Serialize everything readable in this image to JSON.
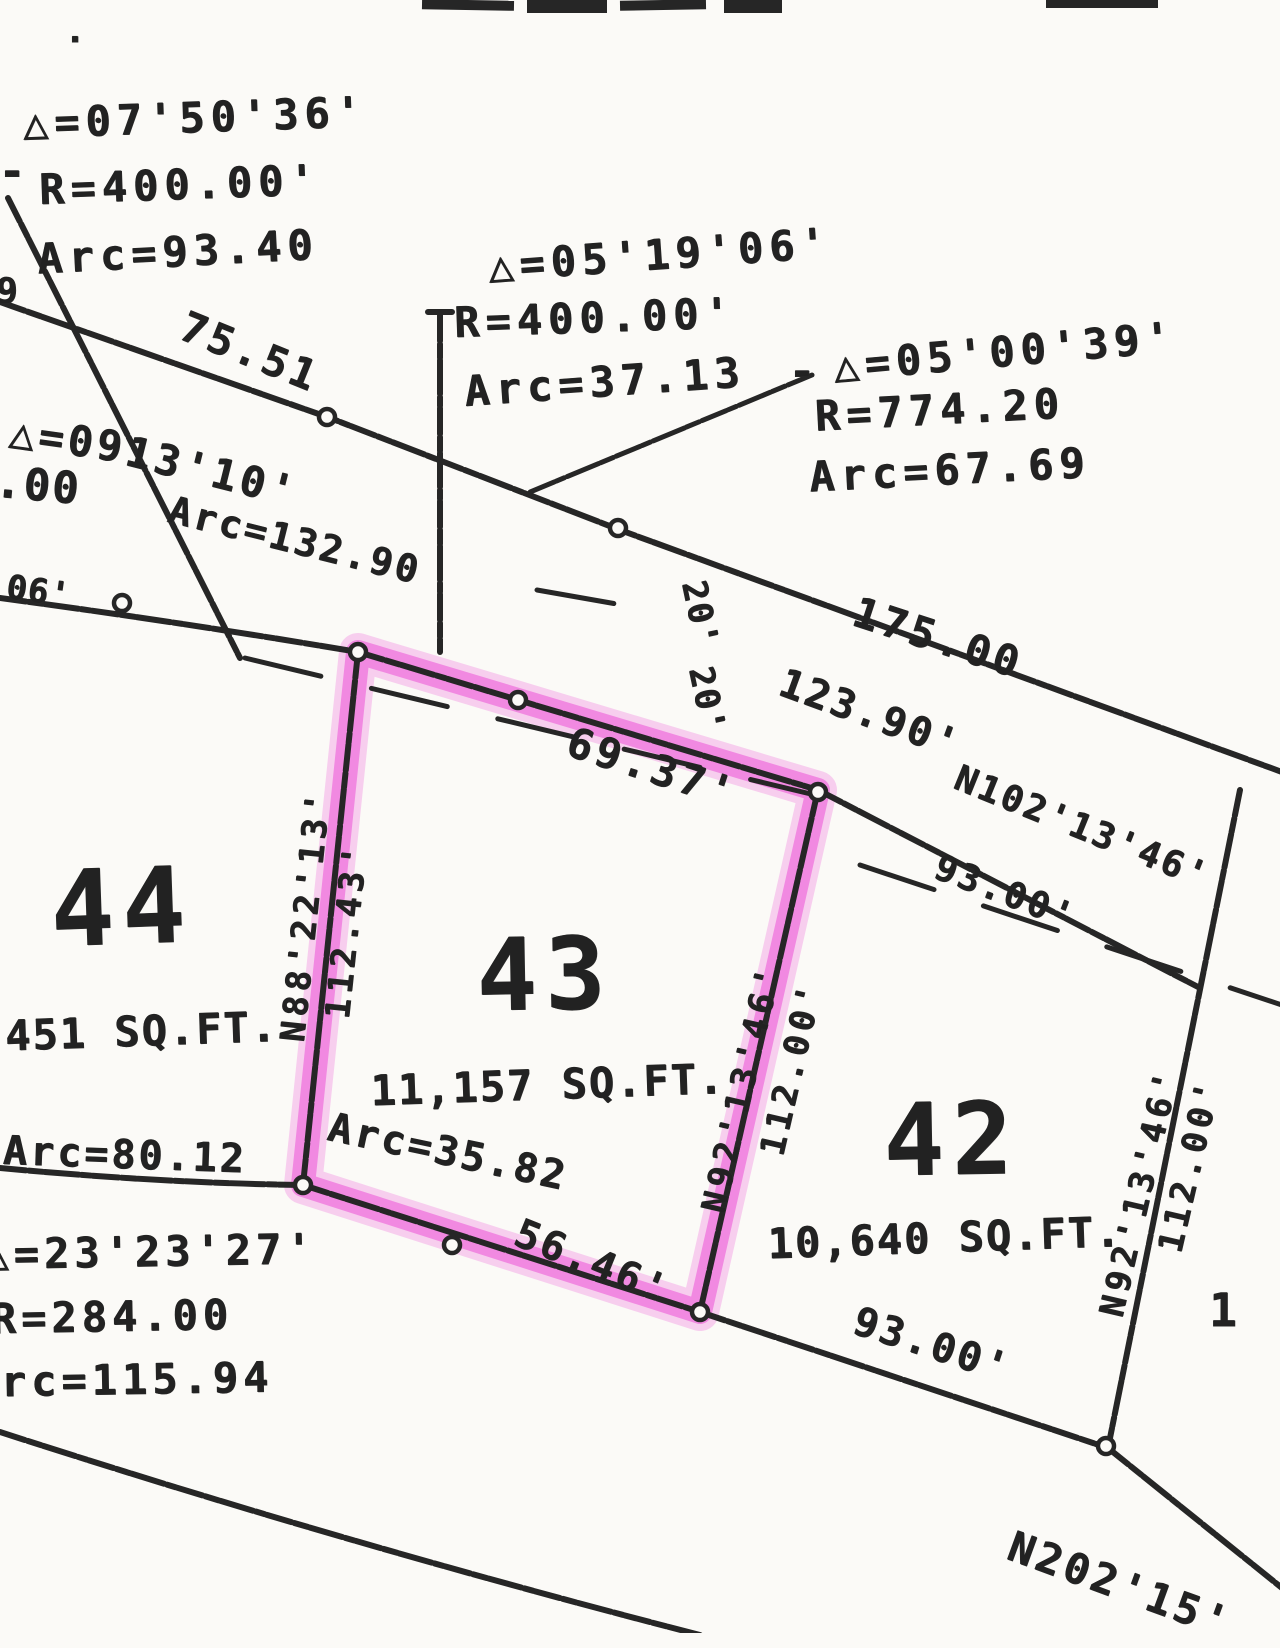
{
  "document": {
    "kind_label": "plat-survey-scan",
    "highlighted_lot": "43"
  },
  "colors": {
    "ink": "#262626",
    "highlighter_pink": "#ee5fd9",
    "paper": "#fbfaf7"
  },
  "lots": [
    {
      "number": "44",
      "area": ",451 SQ.FT."
    },
    {
      "number": "43",
      "area": "11,157 SQ.FT.",
      "highlighted": true,
      "edges": {
        "north": "69.37'",
        "west": "112.43'",
        "west_bearing": "N88'22'13'",
        "east": "112.00'",
        "east_bearing": "N92'13'46'",
        "south_arc": "Arc=35.82",
        "south_tangent": "56.46'"
      }
    },
    {
      "number": "42",
      "area": "10,640 SQ.FT.",
      "edges": {
        "north": "93.00'",
        "east": "112.00'",
        "east_bearing": "N92'13'46'",
        "south": "93.00'"
      }
    }
  ],
  "curve_tables": [
    {
      "delta": "△=07'50'36'",
      "radius": "R=400.00'",
      "arc": "Arc=93.40"
    },
    {
      "delta": "△=05'19'06'",
      "radius": "R=400.00'",
      "arc": "Arc=37.13"
    },
    {
      "delta": "△=05'00'39'",
      "radius": "R=774.20",
      "arc": "Arc=67.69"
    },
    {
      "delta": "△=09 13'10'",
      "radius": ".00",
      "arc": "Arc=132.90"
    },
    {
      "delta": "△=23'23'27'",
      "radius": "R=284.00",
      "arc": "Arc=115.94"
    }
  ],
  "street_dimensions": [
    "75.51",
    "175.00",
    "123.90'",
    "Arc=80.12",
    "20'",
    "20'",
    ".06'",
    "N102'13'46'",
    "N202'15'"
  ],
  "labels": [
    {
      "n": "curve-a-delta",
      "t": "△=07'50'36'",
      "x": 195,
      "y": 118,
      "s": 42,
      "r": -2,
      "ls": 6
    },
    {
      "n": "curve-a-dash",
      "t": "-",
      "x": 12,
      "y": 172,
      "s": 44,
      "r": 0,
      "ls": 0
    },
    {
      "n": "curve-a-radius",
      "t": "R=400.00'",
      "x": 180,
      "y": 185,
      "s": 42,
      "r": -2,
      "ls": 6
    },
    {
      "n": "curve-a-arc",
      "t": "Arc=93.40",
      "x": 178,
      "y": 252,
      "s": 42,
      "r": -3,
      "ls": 6
    },
    {
      "n": "curve-b-delta",
      "t": "△=05'19'06'",
      "x": 660,
      "y": 255,
      "s": 42,
      "r": -4,
      "ls": 6
    },
    {
      "n": "curve-b-radius",
      "t": "R=400.00'",
      "x": 595,
      "y": 318,
      "s": 42,
      "r": -2,
      "ls": 6
    },
    {
      "n": "curve-b-arc",
      "t": "Arc=37.13",
      "x": 605,
      "y": 382,
      "s": 42,
      "r": -4,
      "ls": 6
    },
    {
      "n": "curve-c-delta",
      "t": "△=05'00'39'",
      "x": 1005,
      "y": 352,
      "s": 42,
      "r": -5,
      "ls": 6
    },
    {
      "n": "curve-c-dash",
      "t": "-",
      "x": 802,
      "y": 372,
      "s": 44,
      "r": 0,
      "ls": 0
    },
    {
      "n": "curve-c-radius",
      "t": "R=774.20",
      "x": 940,
      "y": 410,
      "s": 42,
      "r": -3,
      "ls": 6
    },
    {
      "n": "curve-c-arc",
      "t": "Arc=67.69",
      "x": 950,
      "y": 470,
      "s": 42,
      "r": -3,
      "ls": 6
    },
    {
      "n": "dim-75-51",
      "t": "75.51",
      "x": 250,
      "y": 352,
      "s": 42,
      "r": 22,
      "ls": 4
    },
    {
      "n": "curve-d-delta-1",
      "t": "△=09",
      "x": 68,
      "y": 440,
      "s": 42,
      "r": 8,
      "ls": 4
    },
    {
      "n": "curve-d-delta-2",
      "t": "13'10'",
      "x": 212,
      "y": 472,
      "s": 42,
      "r": 14,
      "ls": 4
    },
    {
      "n": "curve-d-radius-frag",
      "t": ".00",
      "x": 38,
      "y": 486,
      "s": 44,
      "r": 5,
      "ls": 2
    },
    {
      "n": "curve-d-arc",
      "t": "Arc=132.90",
      "x": 295,
      "y": 540,
      "s": 38,
      "r": 14,
      "ls": 3
    },
    {
      "n": "edge-frag-9",
      "t": "9",
      "x": 7,
      "y": 292,
      "s": 36,
      "r": 0,
      "ls": 0
    },
    {
      "n": "edge-frag-06",
      "t": ".06'",
      "x": 28,
      "y": 590,
      "s": 34,
      "r": 8,
      "ls": 1
    },
    {
      "n": "dim-175-00",
      "t": "175.00",
      "x": 938,
      "y": 638,
      "s": 42,
      "r": 18,
      "ls": 4
    },
    {
      "n": "dim-123-90",
      "t": "123.90'",
      "x": 870,
      "y": 714,
      "s": 40,
      "r": 20,
      "ls": 3
    },
    {
      "n": "easement-20-upper",
      "t": "20'",
      "x": 700,
      "y": 614,
      "s": 34,
      "r": 78,
      "ls": 2
    },
    {
      "n": "easement-20-lower",
      "t": "20'",
      "x": 707,
      "y": 700,
      "s": 34,
      "r": 78,
      "ls": 2
    },
    {
      "n": "dim-69-37",
      "t": "69.37'",
      "x": 652,
      "y": 768,
      "s": 42,
      "r": 18,
      "ls": 4
    },
    {
      "n": "bearing-n102",
      "t": "N102'13'46'",
      "x": 1082,
      "y": 828,
      "s": 36,
      "r": 22,
      "ls": 3
    },
    {
      "n": "dim-93-00-upper",
      "t": "93.00'",
      "x": 1005,
      "y": 893,
      "s": 36,
      "r": 21,
      "ls": 3
    },
    {
      "n": "lot-44-number",
      "t": "44",
      "x": 122,
      "y": 908,
      "s": 105,
      "r": -2,
      "ls": 8
    },
    {
      "n": "lot-44-area",
      "t": ",451 SQ.FT.",
      "x": 128,
      "y": 1032,
      "s": 42,
      "r": -2,
      "ls": 2
    },
    {
      "n": "bearing-n88",
      "t": "N88'22'13'",
      "x": 306,
      "y": 915,
      "s": 34,
      "r": -84,
      "ls": 5
    },
    {
      "n": "dim-112-43",
      "t": "112.43'",
      "x": 347,
      "y": 930,
      "s": 34,
      "r": -84,
      "ls": 5
    },
    {
      "n": "lot-43-number",
      "t": "43",
      "x": 545,
      "y": 975,
      "s": 100,
      "r": -1,
      "ls": 8
    },
    {
      "n": "lot-43-area",
      "t": "11,157 SQ.FT.",
      "x": 548,
      "y": 1085,
      "s": 42,
      "r": -2,
      "ls": 2
    },
    {
      "n": "arc-35-82",
      "t": "Arc=35.82",
      "x": 448,
      "y": 1152,
      "s": 40,
      "r": 12,
      "ls": 3
    },
    {
      "n": "dim-56-46",
      "t": "56.46'",
      "x": 592,
      "y": 1262,
      "s": 40,
      "r": 22,
      "ls": 3
    },
    {
      "n": "bearing-n92-lot43",
      "t": "N92'13'46'",
      "x": 742,
      "y": 1088,
      "s": 34,
      "r": -77,
      "ls": 5
    },
    {
      "n": "dim-112-00-lot43",
      "t": "112.00'",
      "x": 792,
      "y": 1068,
      "s": 34,
      "r": -77,
      "ls": 5
    },
    {
      "n": "lot-42-number",
      "t": "42",
      "x": 952,
      "y": 1140,
      "s": 100,
      "r": -1,
      "ls": 8
    },
    {
      "n": "lot-42-area",
      "t": "10,640 SQ.FT.",
      "x": 945,
      "y": 1238,
      "s": 42,
      "r": -2,
      "ls": 2
    },
    {
      "n": "arc-80-12",
      "t": "Arc=80.12",
      "x": 125,
      "y": 1155,
      "s": 40,
      "r": 2,
      "ls": 3
    },
    {
      "n": "curve-e-delta",
      "t": "△=23'23'27'",
      "x": 150,
      "y": 1252,
      "s": 42,
      "r": -1,
      "ls": 5
    },
    {
      "n": "curve-e-radius",
      "t": "R=284.00",
      "x": 112,
      "y": 1317,
      "s": 42,
      "r": -1,
      "ls": 5
    },
    {
      "n": "curve-e-arc",
      "t": "Arc=115.94",
      "x": 122,
      "y": 1380,
      "s": 42,
      "r": -1,
      "ls": 5
    },
    {
      "n": "dim-93-00-lower",
      "t": "93.00'",
      "x": 932,
      "y": 1345,
      "s": 40,
      "r": 18,
      "ls": 3
    },
    {
      "n": "bearing-n92-lot42",
      "t": "N92'13'46'",
      "x": 1140,
      "y": 1192,
      "s": 34,
      "r": -77,
      "ls": 5
    },
    {
      "n": "dim-112-00-lot42",
      "t": "112.00'",
      "x": 1190,
      "y": 1165,
      "s": 34,
      "r": -77,
      "ls": 5
    },
    {
      "n": "lot-41-number-partial",
      "t": "1",
      "x": 1223,
      "y": 1310,
      "s": 46,
      "r": 0,
      "ls": 0
    },
    {
      "n": "bearing-n202",
      "t": "N202'15'",
      "x": 1120,
      "y": 1585,
      "s": 42,
      "r": 20,
      "ls": 4
    },
    {
      "n": "scan-speck",
      "t": "·",
      "x": 75,
      "y": 40,
      "s": 34,
      "r": 0,
      "ls": 0
    }
  ]
}
